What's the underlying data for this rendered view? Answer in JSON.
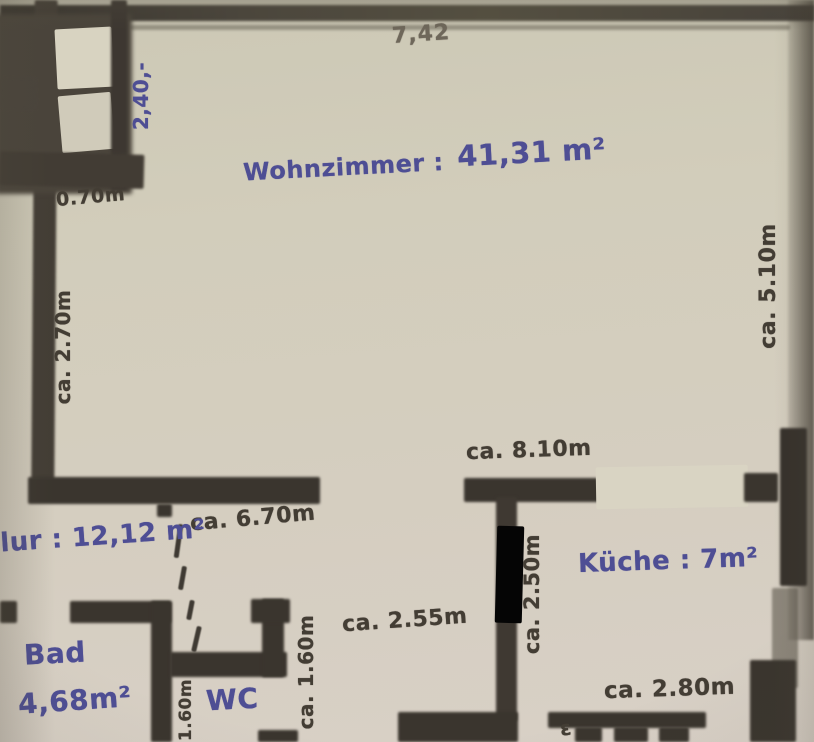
{
  "plan_title": "apartment-floor-plan",
  "rooms": {
    "wohnzimmer_label": "Wohnzimmer :",
    "wohnzimmer_value": "41,31 m²",
    "flur": "Flur : 12,12 m²",
    "kueche": "Küche : 7m²",
    "bad_name": "Bad",
    "bad_area": "4,68m²",
    "wc": "WC"
  },
  "measurements": {
    "top_width": "7,42",
    "balcony_height": "2,40,-",
    "entry_width": "0.70m",
    "left_height": "ca. 2.70m",
    "right_height": "ca. 5.10m",
    "middle_width": "ca. 8.10m",
    "flur_width": "ca. 6.70m",
    "corridor_width": "ca. 2.55m",
    "kueche_depth": "ca. 2.50m",
    "wc_depth": "ca. 1.60m",
    "wc_width": "1.60m",
    "kueche_width": "ca. 2.80m"
  },
  "marks": {
    "pencil_mark": "ε"
  },
  "colors": {
    "ink_blue": "#4e4e94",
    "pencil_dark": "#433d34",
    "wall_dark": "#3a352e",
    "paper": "#d2cdbb"
  }
}
